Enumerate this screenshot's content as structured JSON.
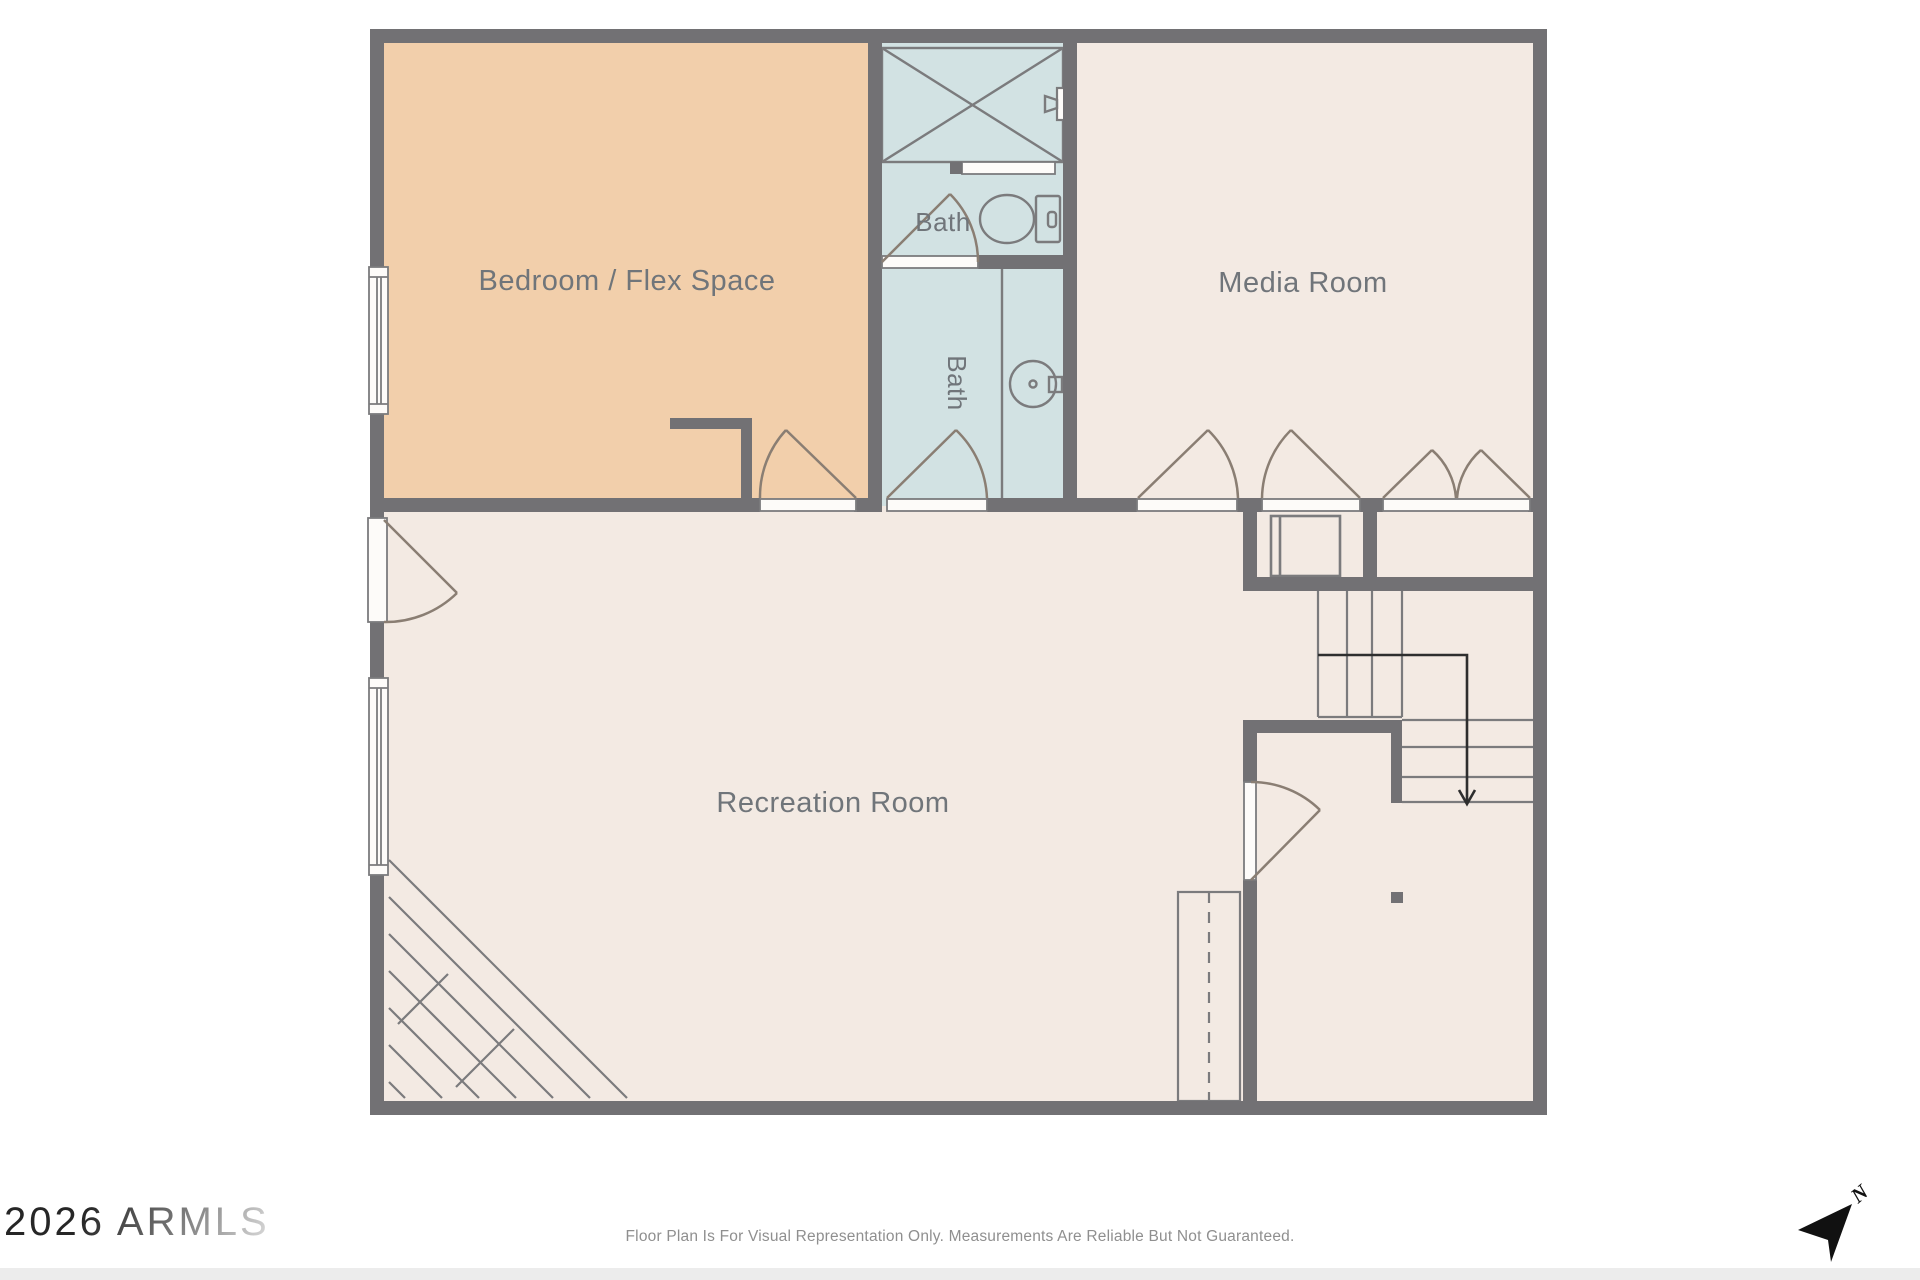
{
  "plan": {
    "colors": {
      "wall": "#727174",
      "line": "#7b7b7d",
      "arc": "#8a7e73",
      "label": "#70757a",
      "bedroom": "#f2cfab",
      "bath": "#d2e2e3",
      "room": "#f3eae3",
      "stairs_arrow": "#2e2e2e",
      "compass": "#111111"
    },
    "rooms": {
      "bedroom": {
        "label": "Bedroom / Flex Space"
      },
      "bath_upper": {
        "label": "Bath"
      },
      "bath_lower": {
        "label": "Bath"
      },
      "media": {
        "label": "Media Room"
      },
      "recreation": {
        "label": "Recreation Room"
      }
    },
    "fixtures": [
      "shower",
      "towel-bar",
      "shower-valve",
      "toilet",
      "sink",
      "stairs-down-arrow",
      "corner-stairs",
      "structural-post",
      "utility-chase",
      "north-arrow"
    ]
  },
  "footer": {
    "watermark": "2026 ARMLS",
    "disclaimer": "Floor Plan Is For Visual Representation Only. Measurements Are Reliable But Not Guaranteed.",
    "compass_label": "N"
  }
}
